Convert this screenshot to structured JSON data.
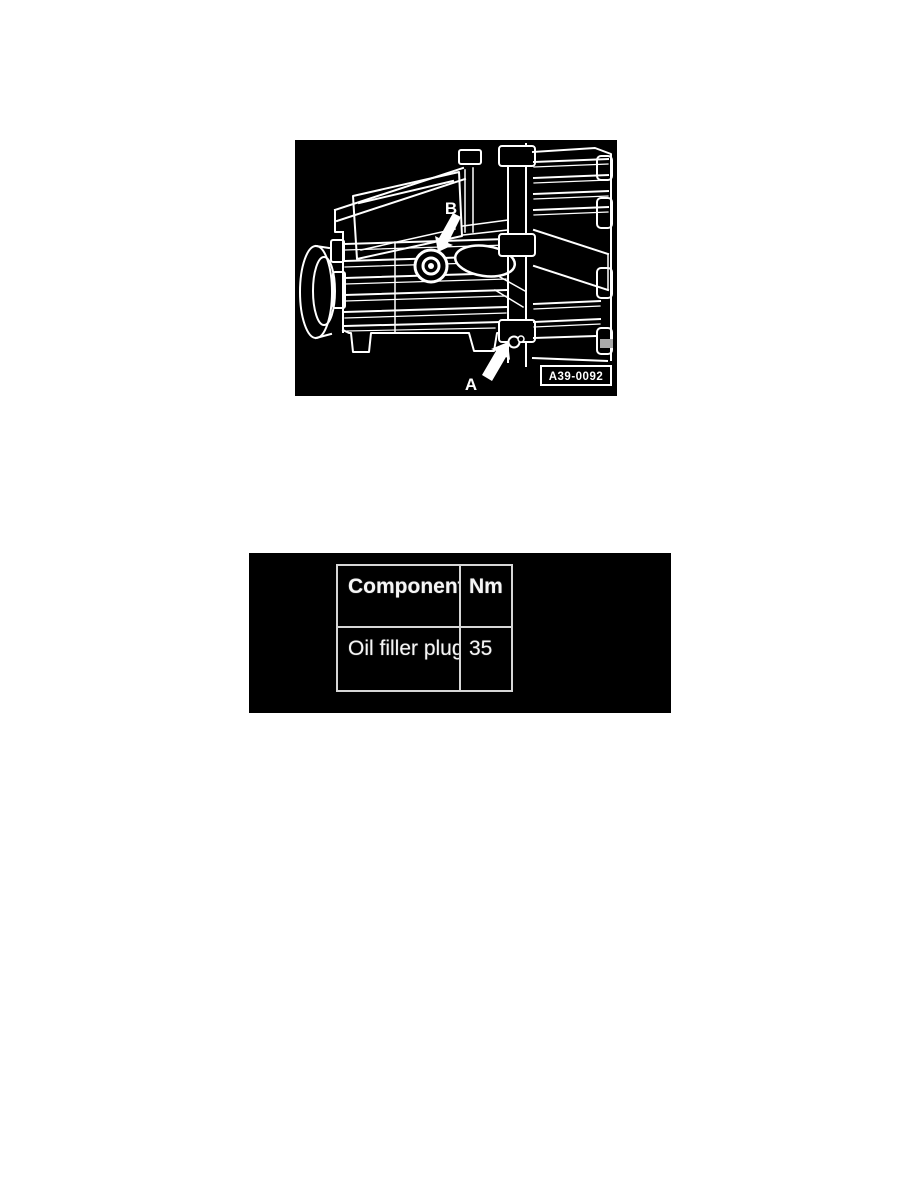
{
  "figure": {
    "label_b": "B",
    "label_a": "A",
    "figure_code": "A39-0092",
    "colors": {
      "background": "#000000",
      "line": "#ffffff"
    }
  },
  "torque_table": {
    "col_component": "Component",
    "col_nm": "Nm",
    "rows": [
      {
        "component": "Oil filler plug",
        "nm": "35"
      }
    ],
    "colors": {
      "background": "#000000",
      "border": "#d6d6d6",
      "text": "#f5f5f5"
    }
  }
}
